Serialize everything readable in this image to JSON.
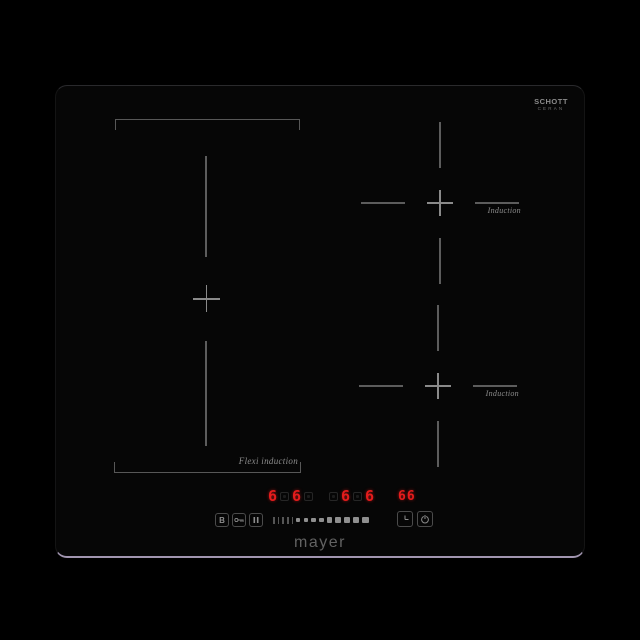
{
  "background_color": "#000000",
  "hob": {
    "surface_color": "#060606",
    "bottom_edge_highlight_color": "#c9badb",
    "marking_color": "#5c5c5c",
    "glass_brand": {
      "line1": "SCHOTT",
      "line2": "CERAN"
    },
    "brand": "mayer",
    "zones": {
      "flexi": {
        "label": "Flexi induction"
      },
      "upper_right": {
        "label": "Induction"
      },
      "lower_right": {
        "label": "Induction"
      }
    },
    "display": {
      "led_color": "#e41c1c",
      "levels": [
        "6",
        "6",
        "6",
        "6"
      ],
      "timer": "66"
    },
    "controls": {
      "boost_label": "B",
      "slider": {
        "ticks": 5,
        "squares": 9
      },
      "icons": [
        "key-lock-icon",
        "pause-icon",
        "timer-clock-icon",
        "power-icon"
      ]
    }
  }
}
